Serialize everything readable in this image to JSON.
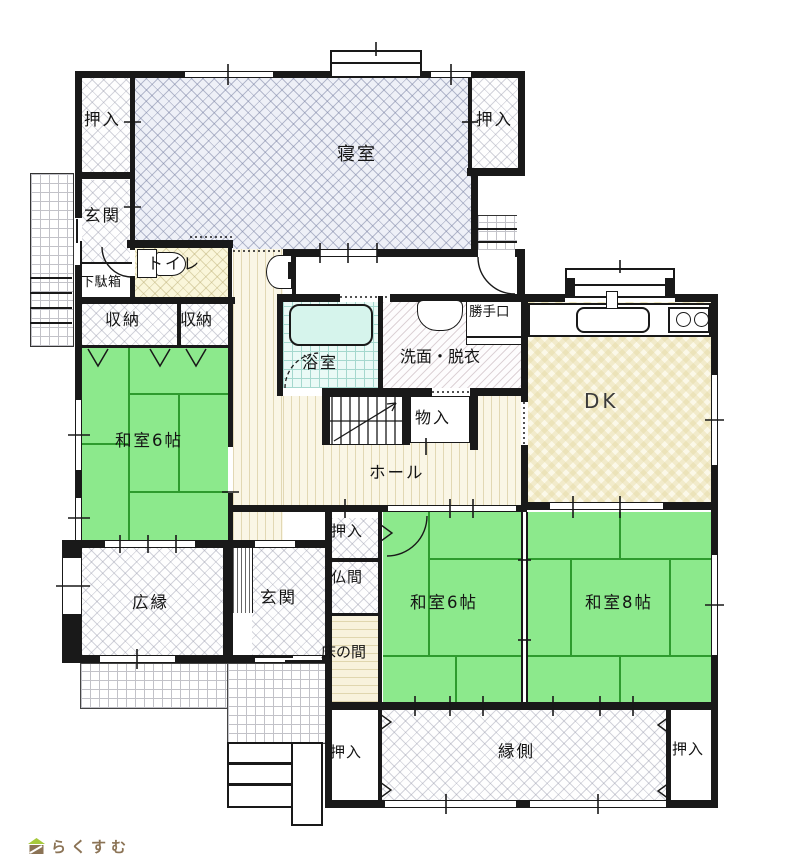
{
  "plan": {
    "labels": {
      "oshiire_nw": "押入",
      "shinshitsu": "寝室",
      "oshiire_ne": "押入",
      "genkan_north": "玄関",
      "getabako": "下駄箱",
      "toire": "トイレ",
      "shuno_1": "収納",
      "shuno_2": "収納",
      "washitsu6_west": "和室6帖",
      "yokushitsu": "浴室",
      "senmen_datsui": "洗面・脱衣",
      "katteguchi": "勝手口",
      "dk": "DK",
      "monoiri": "物入",
      "hall": "ホール",
      "oshiire_mid": "押入",
      "butsuma": "仏間",
      "tokonoma": "床の間",
      "hiroen": "広縁",
      "genkan_south": "玄関",
      "washitsu6_south": "和室6帖",
      "washitsu8": "和室8帖",
      "engawa": "縁側",
      "oshiire_sw": "押入",
      "oshiire_se": "押入"
    },
    "colors": {
      "wall": "#191919",
      "tatami_green": "#8ce98c",
      "bath_cyan": "#eafaf6",
      "wood_cream": "#faf6e6",
      "bedroom_lattice": "#eef0f7"
    }
  },
  "footer": {
    "logo_text": "らくすむ"
  }
}
